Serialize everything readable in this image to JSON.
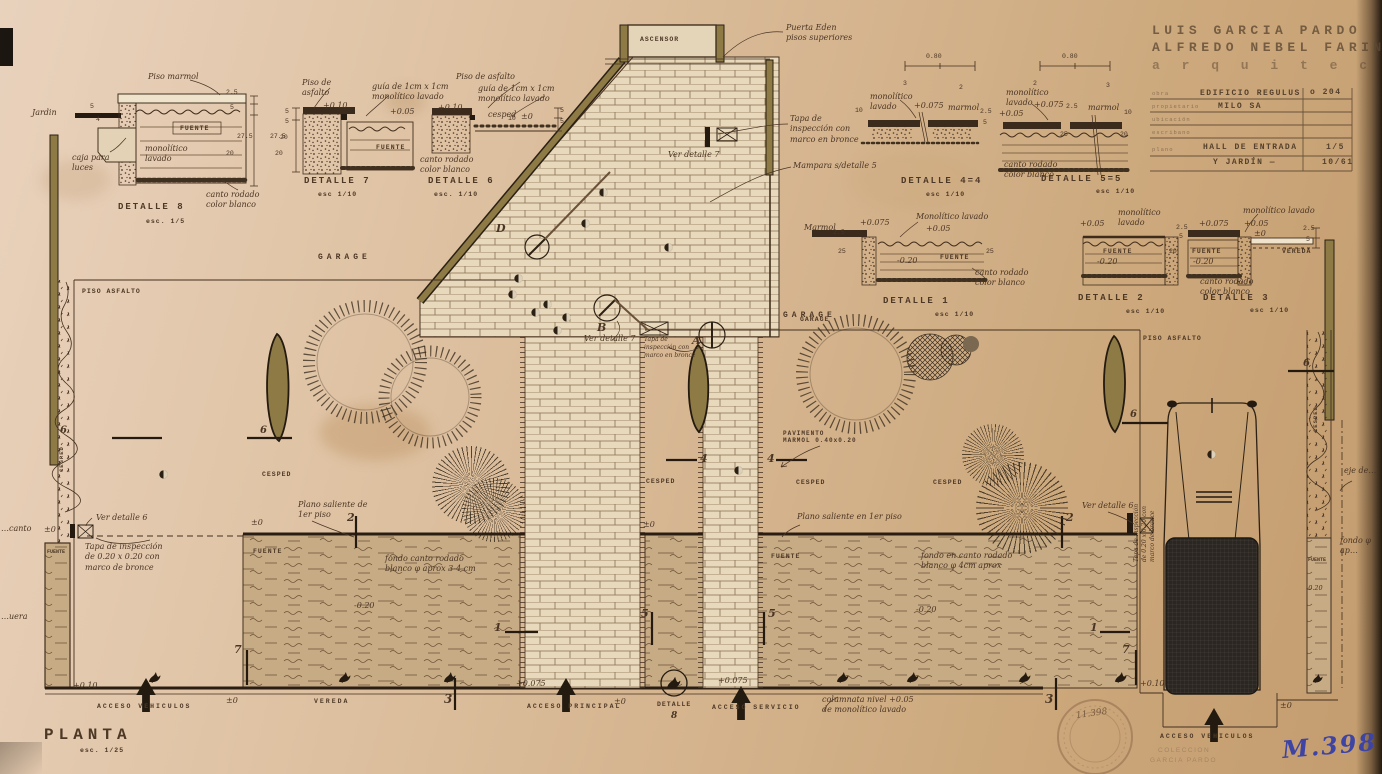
{
  "plan": {
    "title": "PLANTA",
    "scale": "esc. 1/25"
  },
  "title_block": {
    "architect1": "LUIS GARCIA PARDO",
    "architect2": "ALFREDO NEBEL FARINI",
    "profession": "a r q u i t e c t o s",
    "rows": {
      "r1_label": "obra",
      "r1_value": "EDIFICIO REGULUS",
      "r1_right": "o 204",
      "r2_label": "propietario",
      "r2_value": "MILO SA",
      "r3_label": "ubicación",
      "r4_label": "escribano",
      "r5_label": "plano",
      "r5_value": "HALL DE ENTRADA",
      "r5_right": "1/5",
      "r6_value": "Y JARDÍN —",
      "r6_right": "10/61"
    }
  },
  "details": {
    "d8": {
      "title": "DETALLE 8",
      "scale": "esc. 1/5"
    },
    "d7": {
      "title": "DETALLE 7",
      "scale": "esc 1/10"
    },
    "d6": {
      "title": "DETALLE 6",
      "scale": "esc. 1/10"
    },
    "d44": {
      "title": "DETALLE 4=4",
      "scale": "esc 1/10"
    },
    "d55": {
      "title": "DETALLE 5=5",
      "scale": "esc 1/10"
    },
    "d1": {
      "title": "DETALLE 1",
      "scale": "esc 1/10"
    },
    "d2": {
      "title": "DETALLE 2",
      "scale": "esc 1/10"
    },
    "d3": {
      "title": "DETALLE 3",
      "scale": "esc 1/10"
    }
  },
  "areas": {
    "garage": "GARAGE",
    "cesped": "CESPED",
    "fuente": "FUENTE",
    "piso_asfalto": "PISO ASFALTO",
    "vereda": "VEREDA",
    "ascensor": "ASCENSOR",
    "pavimento": "PAVIMENTO\nMARMOL 0.40x0.20",
    "detalle_ref": "DETALLE"
  },
  "accesses": {
    "vehiculos": "ACCESO VEHICULOS",
    "principal": "ACCESO PRINCIPAL",
    "servicio": "ACCESO SERVICIO"
  },
  "levels": {
    "p010": "+0.10",
    "p0075": "+0.075",
    "p005": "+0.05",
    "zero": "±0",
    "m020": "-0.20"
  },
  "notes": {
    "d8_piso": "Piso marmol",
    "d8_jardin": "Jardin",
    "d8_caja": "caja para\nluces",
    "mono2": "monolítico\nlavado",
    "mono1": "monolítico lavado",
    "mono1c": "Monolítico lavado",
    "canto2": "canto rodado\ncolor blanco",
    "marmol": "marmol",
    "marmol_c": "Marmol",
    "d7_piso": "Piso de\nasfalto",
    "guia": "guía de 1cm x 1cm\nmonolítico lavado",
    "d6_piso": "Piso de asfalto",
    "d6_cesped": "cesped",
    "puerta": "Puerta Eden\npisos superiores",
    "tapa3": "Tapa de\ninspección con\nmarco en bronce",
    "mampara": "Mampara s/detalle 5",
    "ver7": "Ver detalle 7",
    "ver6": "Ver detalle 6",
    "tapa020": "Tapa de inspección\nde 0.20 x 0.20 con\nmarco de bronce",
    "saliente_de": "Plano saliente de\n1er piso",
    "saliente_en": "Plano saliente en 1er piso",
    "fondo_izq": "fondo canto rodado\nblanco φ aprox 3-4 cm",
    "fondo_der": "fondo en canto rodado\nblanco φ 4cm aprox",
    "columnata": "columnata nivel +0.05\nde monolítico lavado",
    "edge_eje": "eje de…",
    "edge_fondo": "fondo φ ap…",
    "edge_canto": "…canto",
    "edge_uera": "…uera"
  },
  "markers": {
    "m1": "1",
    "m2": "2",
    "m3": "3",
    "m4": "4",
    "m5": "5",
    "m6": "6",
    "m7": "7",
    "m8": "8",
    "a": "A",
    "b": "B",
    "d": "D"
  },
  "dims": {
    "d275": "27.5",
    "d20": "20",
    "d25": "2.5",
    "d5": "5",
    "d080": "0.80",
    "d25b": "25",
    "d10": "10",
    "d4": "4",
    "d3": "3",
    "d2": "2"
  },
  "stamps": {
    "blue": "M.398",
    "pencil": "11.398",
    "faint1": "COLECCION",
    "faint2": "GARCIA PARDO"
  }
}
